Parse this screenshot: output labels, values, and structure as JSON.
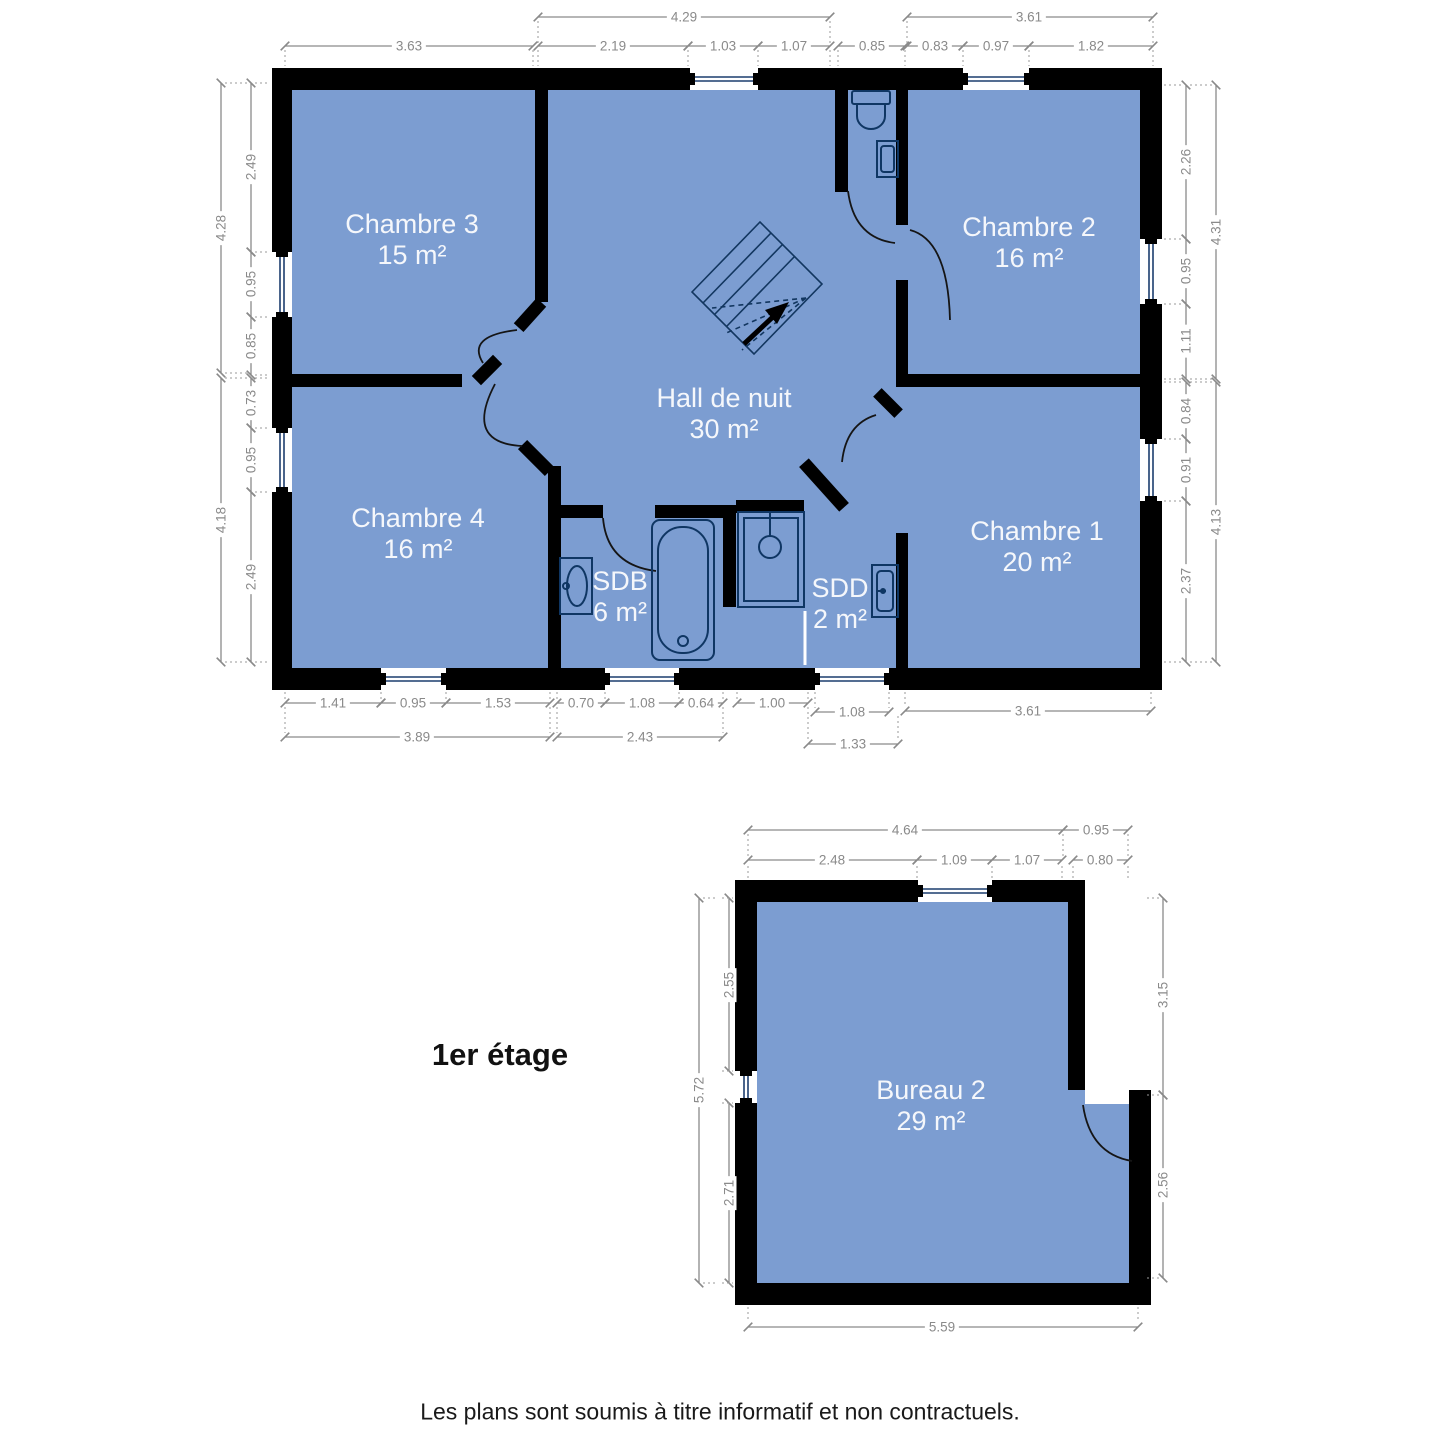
{
  "title": "1er étage",
  "disclaimer": "Les plans sont soumis à titre informatif et non contractuels.",
  "colors": {
    "room_fill": "#7c9dd1",
    "wall": "#000000",
    "dimension": "#8a8a8a",
    "label_text": "#ffffff"
  },
  "main_plan": {
    "rooms": [
      {
        "name": "Chambre 3",
        "area": "15 m²"
      },
      {
        "name": "Chambre 2",
        "area": "16 m²"
      },
      {
        "name": "Chambre 4",
        "area": "16 m²"
      },
      {
        "name": "Hall de nuit",
        "area": "30 m²"
      },
      {
        "name": "Chambre 1",
        "area": "20 m²"
      },
      {
        "name": "SDB",
        "area": "6 m²"
      },
      {
        "name": "SDD",
        "area": "2 m²"
      }
    ],
    "dims": {
      "top_row1": [
        "4.29",
        "3.61"
      ],
      "top_row2": [
        "3.63",
        "2.19",
        "1.03",
        "1.07",
        "0.85",
        "0.83",
        "0.97",
        "1.82"
      ],
      "left_outer": [
        "4.28",
        "4.18"
      ],
      "left_inner": [
        "2.49",
        "0.95",
        "0.85",
        "0.73",
        "0.95",
        "2.49"
      ],
      "right_inner": [
        "2.26",
        "0.95",
        "1.11",
        "0.84",
        "0.91",
        "2.37"
      ],
      "right_outer": [
        "4.31",
        "4.13"
      ],
      "bottom_row1": [
        "1.41",
        "0.95",
        "1.53",
        "0.70",
        "1.08",
        "0.64",
        "1.00",
        "1.08",
        "3.61"
      ],
      "bottom_row2": [
        "3.89",
        "2.43",
        "1.33"
      ]
    }
  },
  "annex_plan": {
    "rooms": [
      {
        "name": "Bureau 2",
        "area": "29 m²"
      }
    ],
    "dims": {
      "top_row1": [
        "4.64",
        "0.95"
      ],
      "top_row2": [
        "2.48",
        "1.09",
        "1.07",
        "0.80"
      ],
      "left_outer": [
        "5.72"
      ],
      "left_inner": [
        "2.55",
        "2.71"
      ],
      "right": [
        "3.15",
        "2.56"
      ],
      "bottom": [
        "5.59"
      ]
    }
  }
}
